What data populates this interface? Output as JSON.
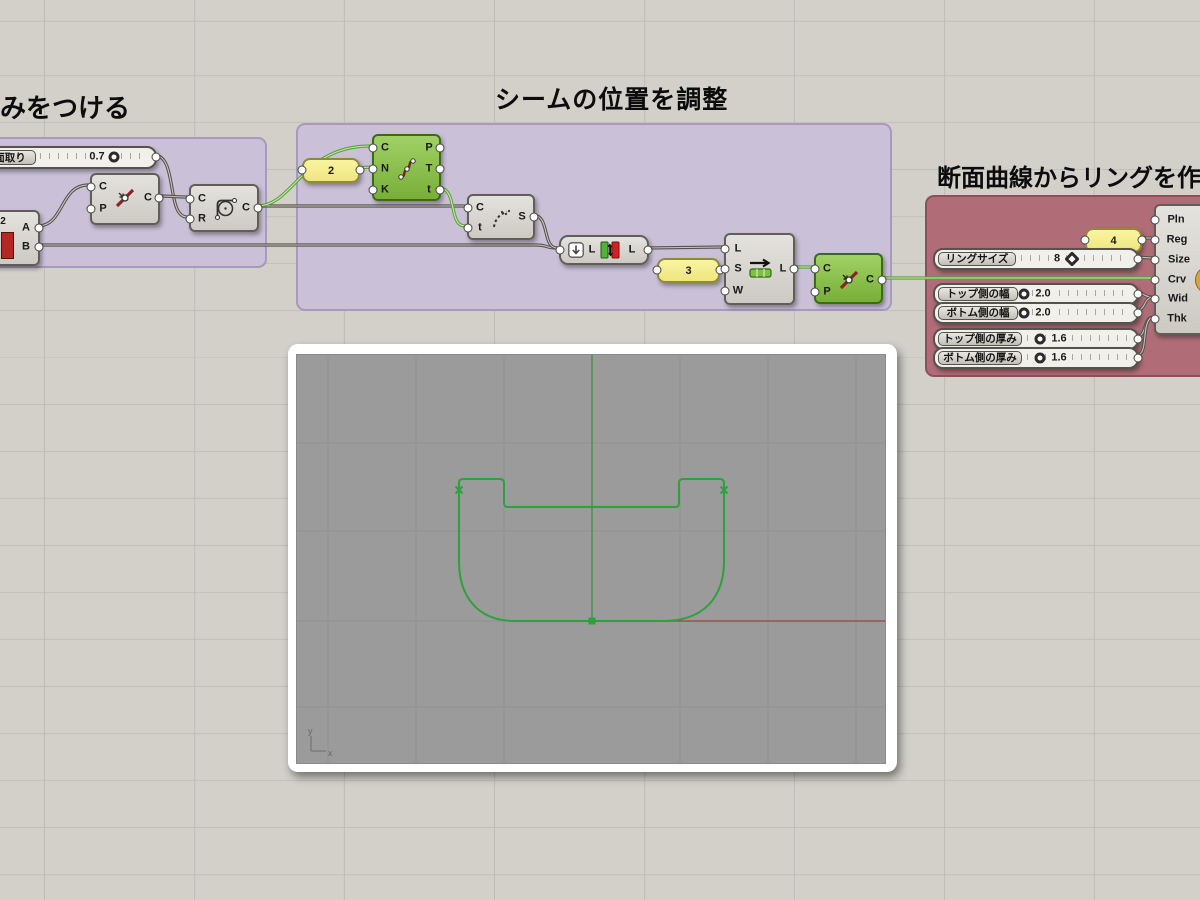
{
  "titles": {
    "left": "丸みをつける",
    "middle": "シームの位置を調整",
    "right": "断面曲線からリングを作成"
  },
  "panels": {
    "divide_count": "2",
    "shift_offset": "3",
    "regions": "4"
  },
  "sliders": {
    "fillet": {
      "label": "面取り",
      "value": "0.7"
    },
    "ring_size": {
      "label": "リングサイズ",
      "value": "8"
    },
    "top_width": {
      "label": "トップ側の幅",
      "value": "2.0"
    },
    "bottom_width": {
      "label": "ボトム側の幅",
      "value": "2.0"
    },
    "top_thickness": {
      "label": "トップ側の厚み",
      "value": "1.6"
    },
    "bottom_thickness": {
      "label": "ボトム側の厚み",
      "value": "1.6"
    }
  },
  "components": {
    "split": {
      "outputs": [
        "A",
        "B"
      ],
      "icon_text": "2"
    },
    "flip1": {
      "inputs": [
        "C",
        "P"
      ],
      "outputs": [
        "C"
      ]
    },
    "fillet": {
      "inputs": [
        "C",
        "R"
      ],
      "outputs": [
        "C"
      ]
    },
    "divide": {
      "inputs": [
        "C",
        "N",
        "K"
      ],
      "outputs": [
        "P",
        "T",
        "t"
      ]
    },
    "shatter": {
      "inputs": [
        "C",
        "t"
      ],
      "outputs": [
        "S"
      ]
    },
    "reverse": {
      "inputs": [
        "L"
      ],
      "outputs": [
        "L"
      ]
    },
    "shift": {
      "inputs": [
        "L",
        "S",
        "W"
      ],
      "outputs": [
        "L"
      ]
    },
    "flip2": {
      "inputs": [
        "C",
        "P"
      ],
      "outputs": [
        "C"
      ]
    },
    "ring": {
      "inputs": [
        "Pln",
        "Reg",
        "Size",
        "Crv",
        "Wid",
        "Thk"
      ]
    }
  },
  "viewport": {
    "axis_x": "x",
    "axis_y": "y"
  },
  "colors": {
    "canvas": "#d3d0ca",
    "group_purple": "#cac0d8",
    "group_red": "#b06d77",
    "selected_green": "#78af37",
    "wire_green": "#5aa332",
    "curve_green": "#2da13b",
    "axis_red": "#9c4e4e",
    "viewport_gray": "#9b9b9b"
  }
}
